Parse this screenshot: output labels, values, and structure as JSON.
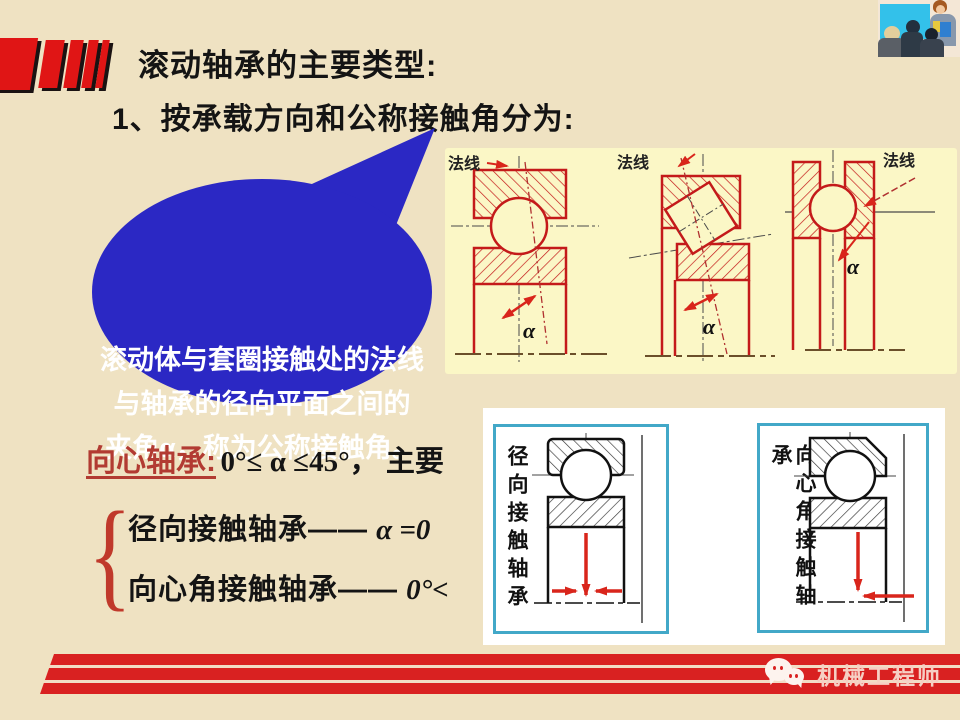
{
  "slide": {
    "title": "滚动轴承的主要类型:",
    "subtitle": "1、按承载方向和公称接触角分为:"
  },
  "bubble": {
    "line1": "滚动体与套圈接触处的法线",
    "line2": "与轴承的径向平面之间的",
    "line3": "夹角α，称为公称接触角。"
  },
  "figure": {
    "normal_label": "法线",
    "alpha_label": "α"
  },
  "classification": {
    "term": "向心轴承:",
    "condition": "0°≤ α ≤45°， 主要",
    "brace": "{",
    "branch1_name": "径向接触轴承——",
    "branch1_value": "α =0",
    "branch2_name": "向心角接触轴承——",
    "branch2_value": "0°<"
  },
  "panels": {
    "left_label": "径向接触轴承",
    "right_label": "向心角接触轴承"
  },
  "footer": {
    "brand": "机械工程师"
  },
  "colors": {
    "background": "#EFE2C2",
    "figure_bg": "#FBF7C6",
    "bubble_blue": "#2B28C4",
    "accent_red": "#D92121",
    "diagram_red": "#C41A1A",
    "term_red": "#B23B32",
    "panel_border_cyan": "#42A8C8",
    "footer_text_pink": "#F6CFC4"
  }
}
